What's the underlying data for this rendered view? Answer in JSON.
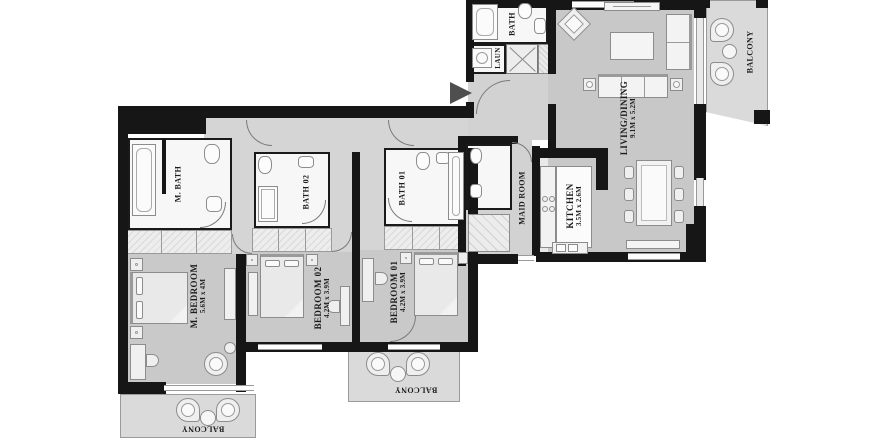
{
  "plan": {
    "type": "apartment-floor-plan",
    "colors": {
      "wall": "#161616",
      "bedroom_floor": "#c9c9c9",
      "corridor_floor": "#d5d5d5",
      "balcony_floor": "#dadada",
      "bath_floor": "#f7f7f7",
      "kitchen_floor": "#e9e9e9",
      "label_text": "#1c1c1c"
    },
    "rooms": {
      "m_bedroom": {
        "name": "M. BEDROOM",
        "dims": "5.6M x 4M"
      },
      "bedroom02": {
        "name": "BEDROOM 02",
        "dims": "4.2M x 3.9M"
      },
      "bedroom01": {
        "name": "BEDROOM 01",
        "dims": "4.2M x 3.9M"
      },
      "m_bath": {
        "name": "M. BATH"
      },
      "bath02": {
        "name": "BATH 02"
      },
      "bath01": {
        "name": "BATH 01"
      },
      "bath": {
        "name": "BATH"
      },
      "laundry": {
        "name": "LAUN"
      },
      "maid_room": {
        "name": "MAID ROOM"
      },
      "kitchen": {
        "name": "KITCHEN",
        "dims": "3.5M x 2.6M"
      },
      "living_dining": {
        "name": "LIVING/DINING",
        "dims": "9.1M x 5.2M"
      },
      "balcony_top": {
        "name": "BALCONY"
      },
      "balcony_left": {
        "name": "BALCONY"
      },
      "balcony_mid": {
        "name": "BALCONY"
      }
    }
  }
}
